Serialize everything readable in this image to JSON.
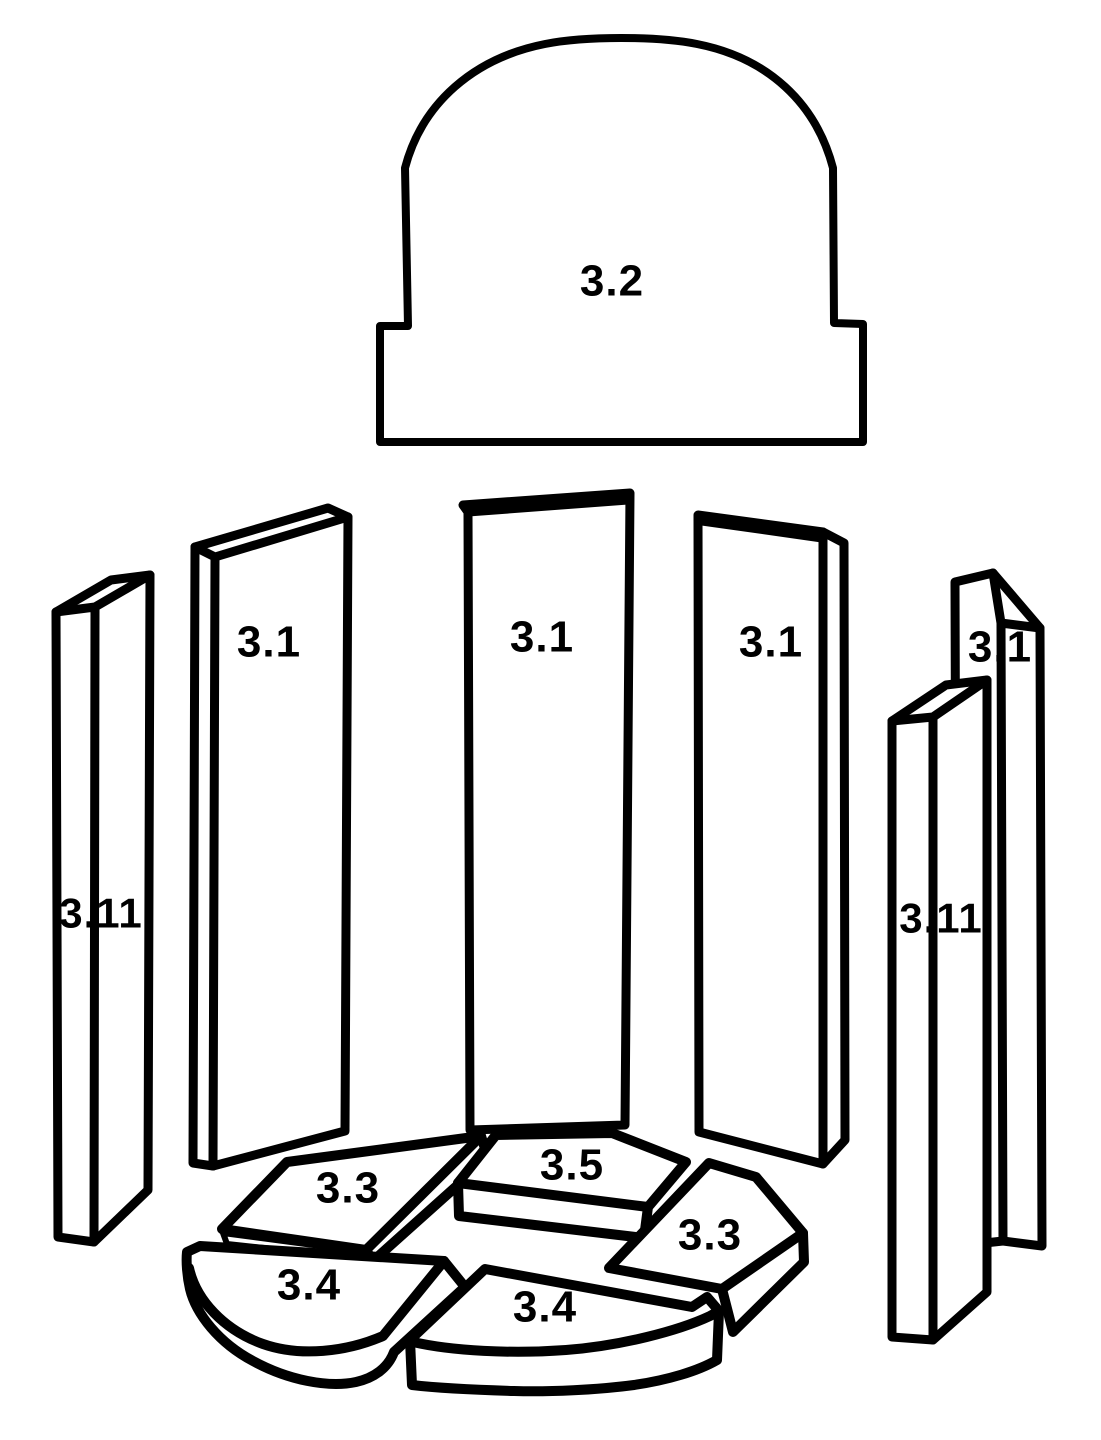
{
  "diagram": {
    "kind": "exploded-parts-diagram",
    "colors": {
      "background": "#FFFFFF",
      "line": "#000000",
      "label": "#000000",
      "highlight": "#F20D05"
    },
    "parts": [
      {
        "id": "top-arch-stone",
        "label": "3.2",
        "highlighted": false
      },
      {
        "id": "side-panel-left",
        "label": "3.1",
        "highlighted": false
      },
      {
        "id": "back-panel-center",
        "label": "3.1",
        "highlighted": false
      },
      {
        "id": "side-panel-right",
        "label": "3.1",
        "highlighted": false
      },
      {
        "id": "side-panel-far-right",
        "label": "3.1",
        "highlighted": false
      },
      {
        "id": "strip-far-left",
        "label": "3.11",
        "highlighted": false
      },
      {
        "id": "strip-right",
        "label": "3.11",
        "highlighted": false
      },
      {
        "id": "floor-plate-back-left",
        "label": "3.3",
        "highlighted": true
      },
      {
        "id": "floor-plate-back-center",
        "label": "3.5",
        "highlighted": false
      },
      {
        "id": "floor-plate-right",
        "label": "3.3",
        "highlighted": false
      },
      {
        "id": "floor-plate-front-left",
        "label": "3.4",
        "highlighted": false
      },
      {
        "id": "floor-plate-front-center",
        "label": "3.4",
        "highlighted": false
      }
    ]
  }
}
